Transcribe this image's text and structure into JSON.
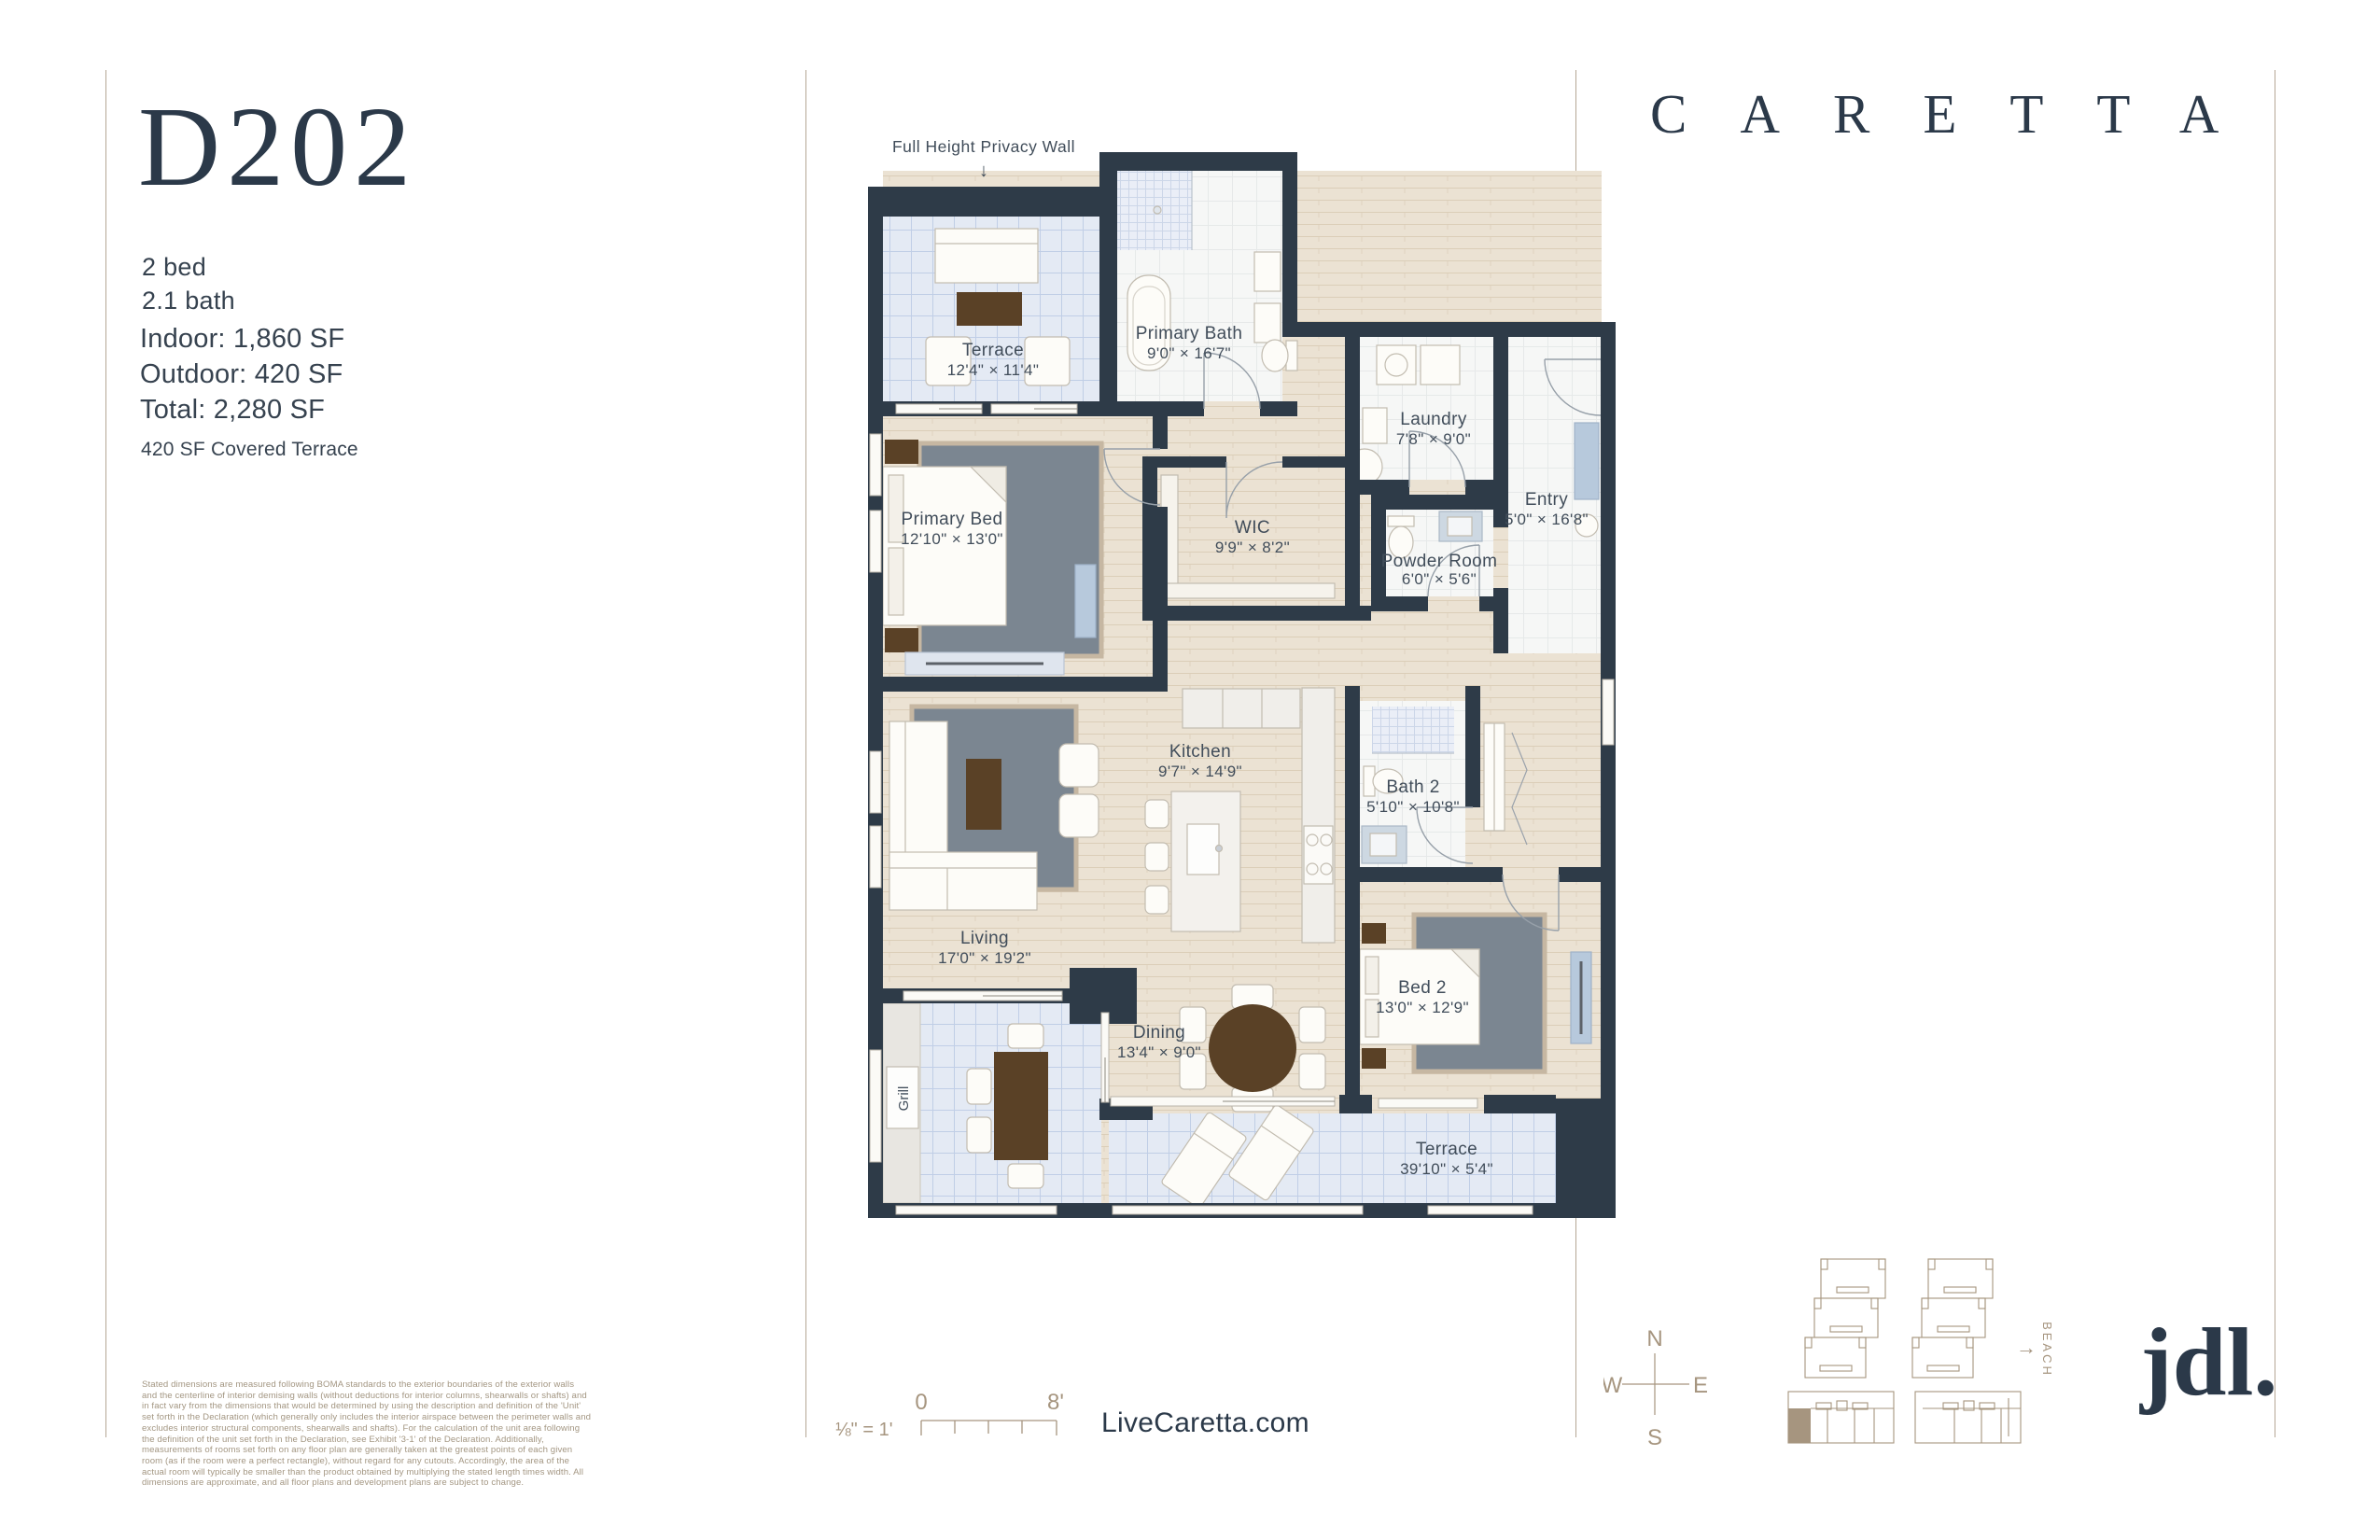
{
  "colors": {
    "navy": "#2b3949",
    "tan": "#a6957f",
    "wall": "#2e3b48",
    "wood_floor": "#ebe2d3",
    "terrace_tile": "#e4eaf4",
    "bath_tile": "#f6f7f6",
    "rug_gray": "#7b8691",
    "table_brown": "#5a4126",
    "furniture_blue": "#b7c9dc"
  },
  "header": {
    "unit_id": "D202",
    "brand": "CARETTA"
  },
  "summary": {
    "beds": "2 bed",
    "baths": "2.1 bath",
    "indoor": "Indoor: 1,860 SF",
    "outdoor": "Outdoor: 420 SF",
    "total": "Total: 2,280 SF",
    "note": "420 SF Covered Terrace"
  },
  "plan": {
    "privacy_wall_note": "Full Height Privacy Wall",
    "privacy_wall_arrow": "↓",
    "grill": "Grill",
    "rooms": [
      {
        "name": "Terrace",
        "dims": "12'4\" × 11'4\""
      },
      {
        "name": "Primary Bath",
        "dims": "9'0\" × 16'7\""
      },
      {
        "name": "Laundry",
        "dims": "7'8\" × 9'0\""
      },
      {
        "name": "Entry",
        "dims": "5'0\" × 16'8\""
      },
      {
        "name": "WIC",
        "dims": "9'9\" × 8'2\""
      },
      {
        "name": "Powder Room",
        "dims": "6'0\" × 5'6\""
      },
      {
        "name": "Primary Bed",
        "dims": "12'10\" × 13'0\""
      },
      {
        "name": "Kitchen",
        "dims": "9'7\" × 14'9\""
      },
      {
        "name": "Bath 2",
        "dims": "5'10\" × 10'8\""
      },
      {
        "name": "Living",
        "dims": "17'0\" × 19'2\""
      },
      {
        "name": "Dining",
        "dims": "13'4\" × 9'0\""
      },
      {
        "name": "Bed 2",
        "dims": "13'0\" × 12'9\""
      },
      {
        "name": "Terrace",
        "dims": "39'10\" × 5'4\""
      }
    ]
  },
  "footer": {
    "scale_label": "⅛\" = 1'",
    "scale_start": "0",
    "scale_end": "8'",
    "website": "LiveCaretta.com",
    "disclaimer": "Stated dimensions are measured following BOMA standards to the exterior boundaries of the exterior walls and the centerline of interior demising walls (without deductions for interior columns, shearwalls or shafts) and in fact vary from the dimensions that would be determined by using the description and definition of the 'Unit' set forth in the Declaration (which generally only includes the interior airspace between the perimeter walls and excludes interior structural components, shearwalls and shafts). For the calculation of the unit area following the definition of the unit set forth in the Declaration, see Exhibit '3-1' of the Declaration. Additionally, measurements of rooms set forth on any floor plan are generally taken at the greatest points of each given room (as if the room were a perfect rectangle), without regard for any cutouts. Accordingly, the area of the actual room will typically be smaller than the product obtained by multiplying the stated length times width. All dimensions are approximate, and all floor plans and development plans are subject to change."
  },
  "compass": {
    "north": "N",
    "south": "S",
    "east": "E",
    "west": "W"
  },
  "site_plan": {
    "beach": "BEACH",
    "beach_arrow": "→"
  },
  "logo": {
    "developer": "jdl."
  }
}
